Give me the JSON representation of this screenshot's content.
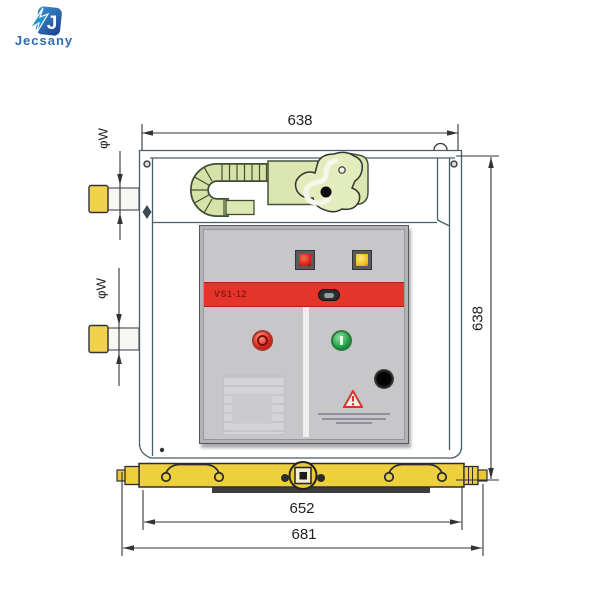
{
  "logo": {
    "brand": "Jecsany",
    "icon": "shield-lightning-icon",
    "color": "#2e6cb5"
  },
  "drawing": {
    "type": "technical-dimension-drawing",
    "subject": "VS1-12 indoor vacuum circuit breaker, front view",
    "dimensions": {
      "top_width": "638",
      "right_height": "638",
      "inner_width": "652",
      "outer_width": "681",
      "bushing_upper": "φW",
      "bushing_lower": "φW"
    },
    "panel": {
      "model": "VS1-12"
    },
    "colors": {
      "line": "#44606a",
      "dimension_line": "#333333",
      "mechanism_green": "#dce6b0",
      "bushing_yellow": "#f2d24b",
      "base_yellow": "#eecf3e",
      "panel_gray": "#c7c7ca",
      "stripe_red": "#e5342c",
      "indicator_red": "#d21d12",
      "indicator_yellow": "#eebc1a",
      "button_red": "#dd2a1d",
      "button_green": "#23a146"
    }
  }
}
